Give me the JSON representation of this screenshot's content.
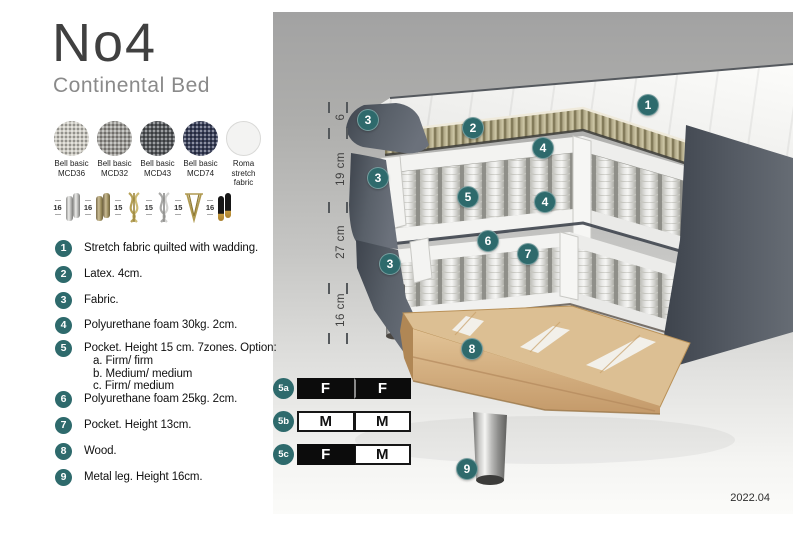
{
  "header": {
    "title": "No4",
    "subtitle": "Continental Bed"
  },
  "swatches": [
    {
      "line1": "Bell basic",
      "line2": "MCD36"
    },
    {
      "line1": "Bell basic",
      "line2": "MCD32"
    },
    {
      "line1": "Bell basic",
      "line2": "MCD43"
    },
    {
      "line1": "Bell basic",
      "line2": "MCD74"
    },
    {
      "line1": "Roma",
      "line2": "stretch fabric"
    }
  ],
  "legs": [
    {
      "size": "16",
      "type": "cylinder-chrome"
    },
    {
      "size": "16",
      "type": "cylinder-bronze"
    },
    {
      "size": "15",
      "type": "curved-gold"
    },
    {
      "size": "15",
      "type": "curved-silver"
    },
    {
      "size": "15",
      "type": "hairpin-gold"
    },
    {
      "size": "16",
      "type": "cylinder-black-gold"
    }
  ],
  "features": [
    {
      "num": "1",
      "text": "Stretch fabric quilted with wadding.",
      "top": 240
    },
    {
      "num": "2",
      "text": "Latex. 4cm.",
      "top": 266
    },
    {
      "num": "3",
      "text": "Fabric.",
      "top": 292
    },
    {
      "num": "4",
      "text": "Polyurethane foam 30kg. 2cm.",
      "top": 317
    },
    {
      "num": "5",
      "text": "Pocket. Height 15 cm. 7zones. Option:",
      "top": 340,
      "options": [
        "a. Firm/ firm",
        "b. Medium/ medium",
        "c. Firm/ medium"
      ]
    },
    {
      "num": "6",
      "text": "Polyurethane foam 25kg. 2cm.",
      "top": 391
    },
    {
      "num": "7",
      "text": "Pocket. Height 13cm.",
      "top": 417
    },
    {
      "num": "8",
      "text": "Wood.",
      "top": 443
    },
    {
      "num": "9",
      "text": "Metal leg. Height 16cm.",
      "top": 469
    }
  ],
  "diagram": {
    "markers": [
      {
        "label": "1",
        "x": 648,
        "y": 105
      },
      {
        "label": "2",
        "x": 473,
        "y": 128
      },
      {
        "label": "3",
        "x": 368,
        "y": 120
      },
      {
        "label": "4",
        "x": 543,
        "y": 148
      },
      {
        "label": "3",
        "x": 378,
        "y": 178
      },
      {
        "label": "5",
        "x": 468,
        "y": 197
      },
      {
        "label": "4",
        "x": 545,
        "y": 202
      },
      {
        "label": "6",
        "x": 488,
        "y": 241
      },
      {
        "label": "7",
        "x": 528,
        "y": 254
      },
      {
        "label": "3",
        "x": 390,
        "y": 264
      },
      {
        "label": "8",
        "x": 472,
        "y": 349
      },
      {
        "label": "9",
        "x": 467,
        "y": 469
      }
    ],
    "dimensions": [
      {
        "label": "6",
        "y": 119
      },
      {
        "label": "19 cm",
        "y": 171
      },
      {
        "label": "27 cm",
        "y": 244
      },
      {
        "label": "16 cm",
        "y": 312
      }
    ],
    "tick_ys": [
      107,
      133,
      207,
      288,
      338
    ],
    "firmness": [
      {
        "id": "5a",
        "top": 378,
        "cells": [
          {
            "letter": "F",
            "variant": "dark"
          },
          {
            "letter": "F",
            "variant": "dark"
          }
        ]
      },
      {
        "id": "5b",
        "top": 411,
        "cells": [
          {
            "letter": "M",
            "variant": "light"
          },
          {
            "letter": "M",
            "variant": "light"
          }
        ]
      },
      {
        "id": "5c",
        "top": 444,
        "cells": [
          {
            "letter": "F",
            "variant": "dark"
          },
          {
            "letter": "M",
            "variant": "light"
          }
        ]
      }
    ],
    "version": "2022.04"
  },
  "colors": {
    "accent_teal": "#2e6a6c",
    "panel_gray_top": "#a2a2a2",
    "bed_fabric_dark": "#565c65",
    "latex_tan": "#b7af8e",
    "wood": "#dcbf93",
    "firmness_dark": "#0c0c0c"
  }
}
